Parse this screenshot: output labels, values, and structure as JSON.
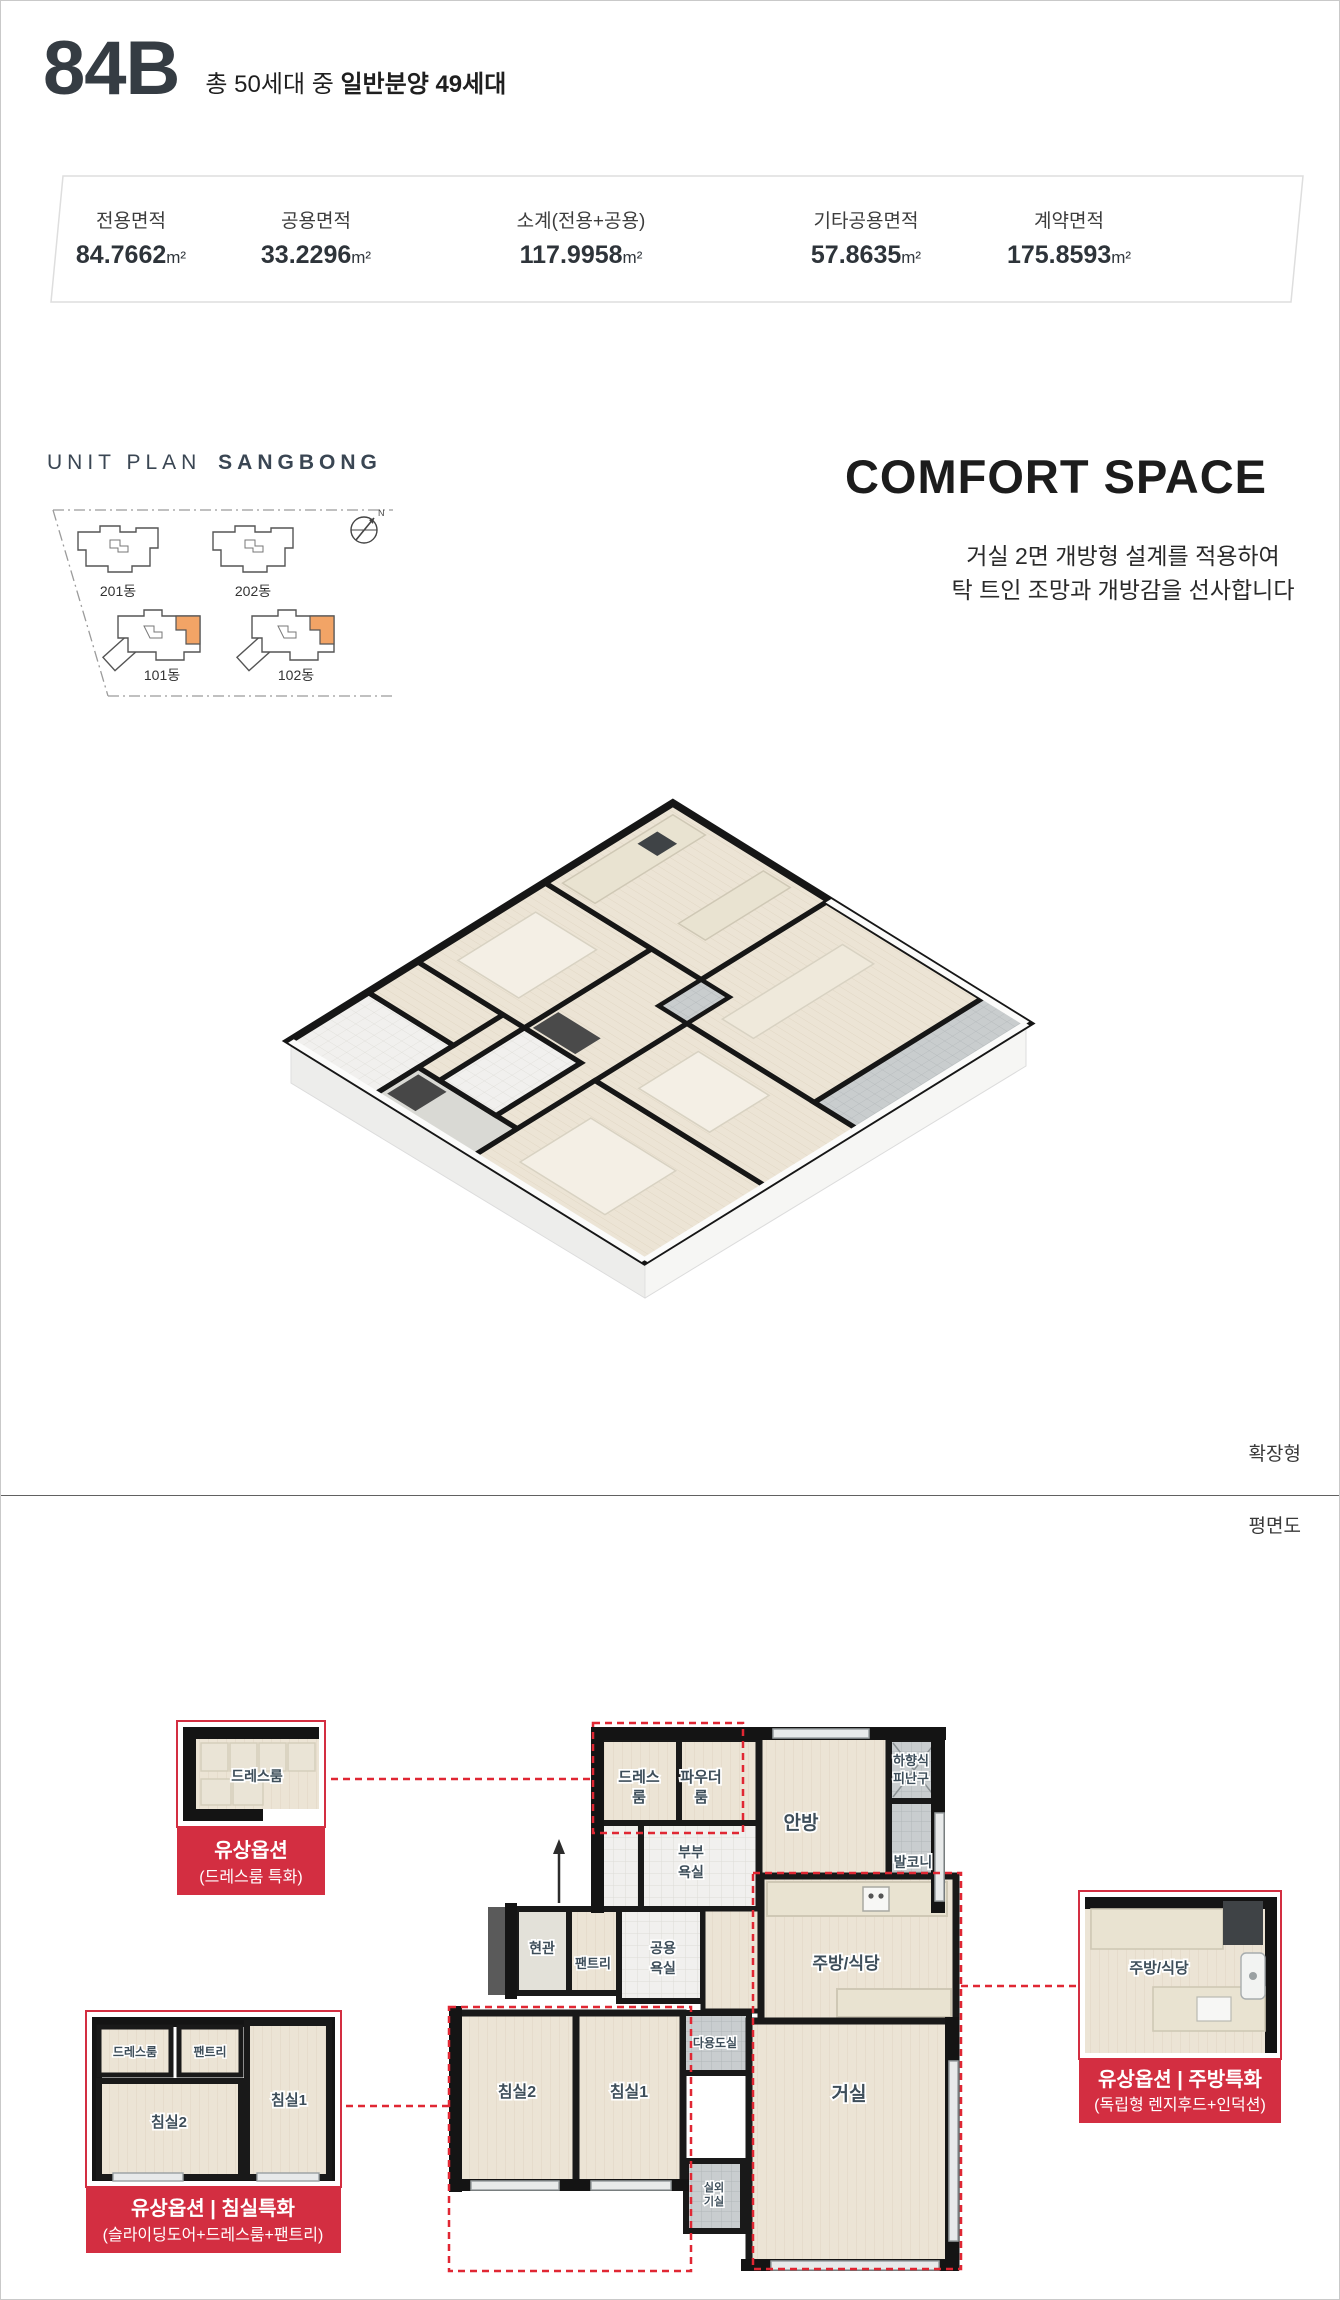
{
  "header": {
    "unit_type": "84B",
    "subtitle_prefix": "총 50세대 중",
    "subtitle_bold": "일반분양 49세대"
  },
  "area_table": {
    "unit": "m²",
    "items": [
      {
        "label": "전용면적",
        "value": "84.7662"
      },
      {
        "label": "공용면적",
        "value": "33.2296"
      },
      {
        "label": "소계(전용+공용)",
        "value": "117.9958"
      },
      {
        "label": "기타공용면적",
        "value": "57.8635"
      },
      {
        "label": "계약면적",
        "value": "175.8593"
      }
    ]
  },
  "unit_plan": {
    "title_light": "UNIT PLAN",
    "title_bold": "SANGBONG",
    "buildings": [
      "201동",
      "202동",
      "101동",
      "102동"
    ],
    "compass_label": "N"
  },
  "comfort": {
    "title": "COMFORT SPACE",
    "line1": "거실 2면 개방형 설계를 적용하여",
    "line2": "탁 트인 조망과 개방감을 선사합니다"
  },
  "iso": {
    "tag": "확장형"
  },
  "plan": {
    "tag": "평면도",
    "labels": {
      "dress": [
        "드레스",
        "룸"
      ],
      "powder": [
        "파우더",
        "룸"
      ],
      "master": [
        "안방"
      ],
      "hatch": [
        "하향식",
        "피난구"
      ],
      "balcony": [
        "발코니"
      ],
      "master_bath": [
        "부부",
        "욕실"
      ],
      "entrance": [
        "현관"
      ],
      "pantry": [
        "팬트리"
      ],
      "common_bath": [
        "공용",
        "욕실"
      ],
      "kitchen": [
        "주방/식당"
      ],
      "bed2": [
        "침실2"
      ],
      "bed1": [
        "침실1"
      ],
      "utility": [
        "다용도실"
      ],
      "living": [
        "거실"
      ],
      "outdoor": [
        "실외",
        "기실"
      ]
    }
  },
  "callouts": {
    "dress": {
      "room": "드레스룸",
      "title": "유상옵션",
      "subtitle": "(드레스룸 특화)"
    },
    "bedroom": {
      "rooms": {
        "dress": "드레스룸",
        "pantry": "팬트리",
        "bed2": "침실2",
        "bed1": "침실1"
      },
      "title": "유상옵션 | 침실특화",
      "subtitle": "(슬라이딩도어+드레스룸+팬트리)"
    },
    "kitchen": {
      "room": "주방/식당",
      "title": "유상옵션 | 주방특화",
      "subtitle": "(독립형 렌지후드+인덕션)"
    }
  },
  "colors": {
    "red": "#D32E41",
    "dash_red": "#E02733",
    "orange": "#F2A466",
    "dark": "#343B42"
  }
}
